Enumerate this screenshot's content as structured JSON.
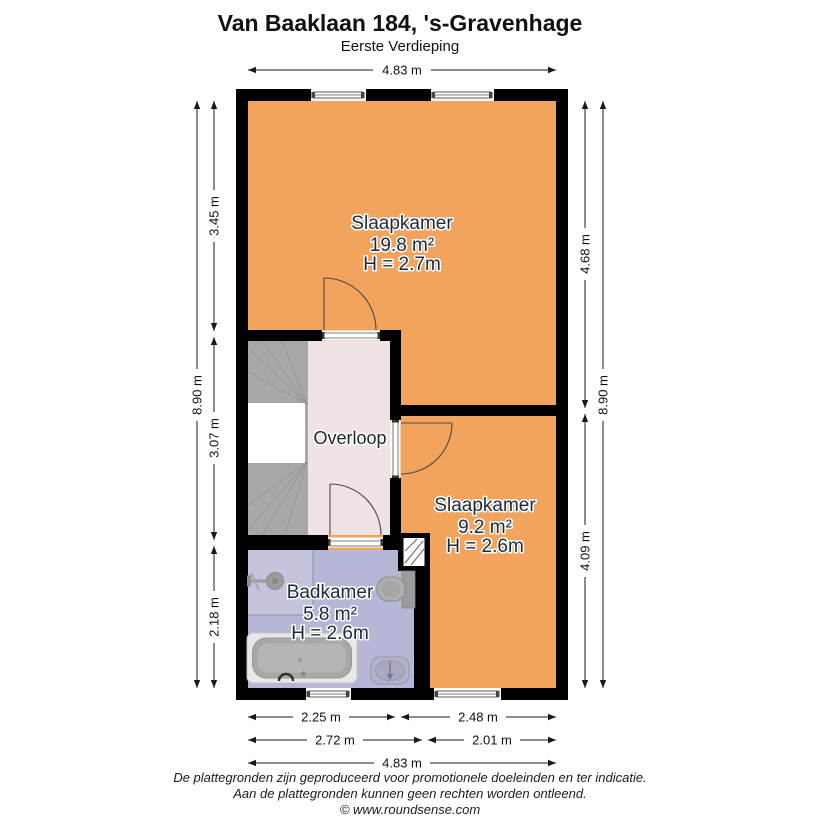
{
  "header": {
    "title": "Van Baaklaan 184, 's-Gravenhage",
    "subtitle": "Eerste Verdieping"
  },
  "rooms": {
    "slaapkamer_1": {
      "name": "Slaapkamer",
      "area": "19.8 m²",
      "ceiling_height": "H = 2.7m"
    },
    "slaapkamer_2": {
      "name": "Slaapkamer",
      "area": "9.2 m²",
      "ceiling_height": "H = 2.6m"
    },
    "badkamer": {
      "name": "Badkamer",
      "area": "5.8 m²",
      "ceiling_height": "H = 2.6m"
    },
    "overloop": {
      "name": "Overloop"
    }
  },
  "dimensions": {
    "top_width": "4.83 m",
    "left_total": "8.90 m",
    "left_segments": [
      "3.45 m",
      "3.07 m",
      "2.18 m"
    ],
    "right_segments": [
      "4.68 m",
      "4.09 m"
    ],
    "right_total": "8.90 m",
    "bottom_row1": [
      "2.25 m",
      "2.48 m"
    ],
    "bottom_row2": [
      "2.72 m",
      "2.01 m"
    ],
    "bottom_total": "4.83 m"
  },
  "footer": {
    "disclaimer_line1": "De plattegronden zijn geproduceerd voor promotionele doeleinden en ter indicatie.",
    "disclaimer_line2": "Aan de plattegronden kunnen geen rechten worden ontleend.",
    "copyright": "© www.roundsense.com"
  },
  "colors": {
    "bedroom_fill": "#F2A45C",
    "hallway_fill": "#F0E3E3",
    "bathroom_fill": "#B6B7D6",
    "stairs_fill": "#A8A8A8",
    "wall": "#000000"
  }
}
